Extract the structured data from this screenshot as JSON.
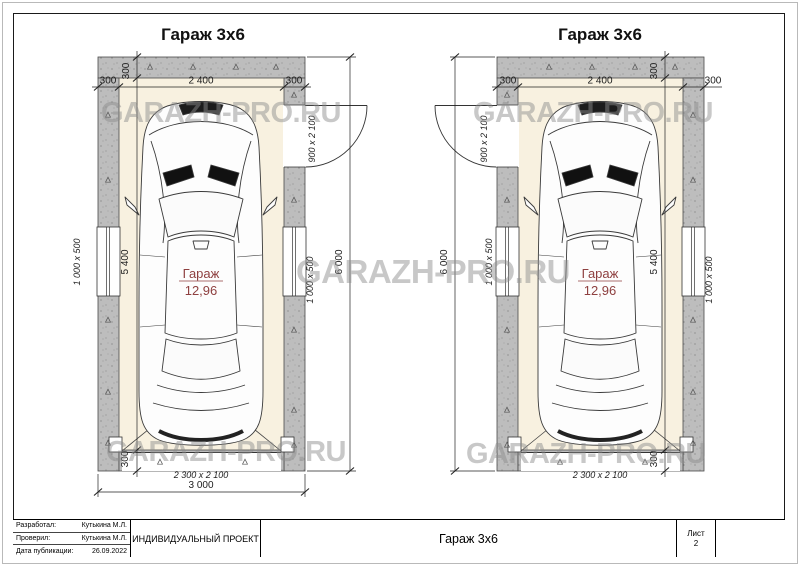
{
  "watermark": {
    "text": "GARAZH-PRO.RU"
  },
  "plan_left": {
    "title": "Гараж 3х6",
    "room": {
      "name": "Гараж",
      "area": "12,96"
    },
    "dims": {
      "wall": "300",
      "interior_width": "2 400",
      "total_width": "3 000",
      "total_length": "6 000",
      "interior_length": "5 400",
      "window": "1 000 x 500",
      "door": "900 x 2 100",
      "gate": "2 300 x 2 100"
    }
  },
  "plan_right": {
    "title": "Гараж 3х6",
    "room": {
      "name": "Гараж",
      "area": "12,96"
    },
    "dims": {
      "wall": "300",
      "interior_width": "2 400",
      "total_length": "6 000",
      "interior_length": "5 400",
      "window": "1 000 x 500",
      "door": "900 x 2 100",
      "gate": "2 300 x 2 100"
    }
  },
  "titleblock": {
    "developed_label": "Разработал:",
    "developed_value": "Кутькина М.Л.",
    "checked_label": "Проверил:",
    "checked_value": "Кутькина М.Л.",
    "published_label": "Дата публикации:",
    "published_value": "26.09.2022",
    "project_type": "ИНДИВИДУАЛЬНЫЙ ПРОЕКТ",
    "drawing_title": "Гараж 3х6",
    "sheet_label": "Лист",
    "sheet_number": "2"
  }
}
